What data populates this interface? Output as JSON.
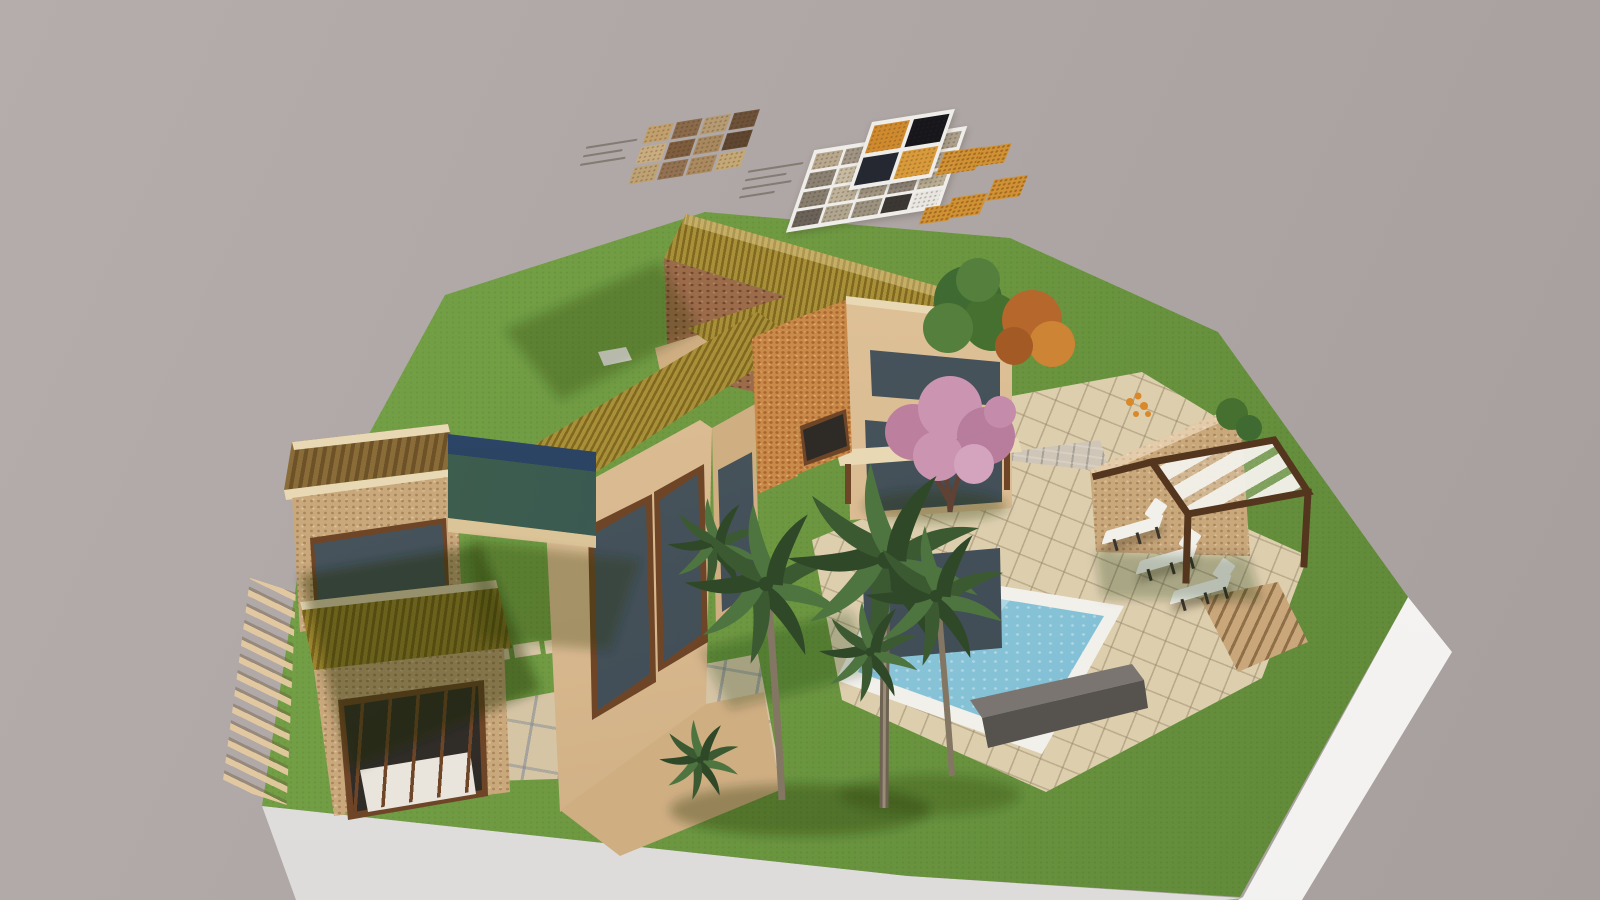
{
  "scene": {
    "type": "3d-architectural-render",
    "description": "Aerial 3D rendering of a Mediterranean stone villa on a floating grass plot with pool, pergola, palm trees, pink blossom tree, stone barn, two stacked stone tower pavilions linked by a glass bridge, paved paths, exterior stairs, and floating material sample boards above the model",
    "objects": [
      "stone-barn",
      "main-villa",
      "tower-pavilion-upper",
      "tower-pavilion-lower",
      "glass-bridge",
      "swimming-pool",
      "pool-bench",
      "pool-terrace",
      "upper-terrace",
      "brick-stair-ramp",
      "wood-steps",
      "floating-stair",
      "paved-path",
      "stepping-stones",
      "pergola",
      "pergola-stone-wall",
      "lounge-chairs",
      "palm-trees",
      "pink-blossom-tree",
      "green-tree",
      "autumn-tree",
      "bushes",
      "material-sample-boards",
      "white-display-plinth"
    ]
  },
  "colors": {
    "background_top": "#b5adab",
    "background_bottom": "#a79f9d",
    "grass": "#6f9a42",
    "grass_dark": "#5c8536",
    "plinth_front": "#e6e5e3",
    "plinth_right": "#f1f0ee",
    "paver": "#ddcfae",
    "path": "#d5c5a5",
    "stone_light": "#c9a87c",
    "stone_dark": "#9c6b4a",
    "roof_gold": "#a8903a",
    "roof_gold_dark": "#80691f",
    "roof_slat": "#8a6c38",
    "roof_slat_dark": "#6d5228",
    "stucco": "#e3c69e",
    "stucco_shade": "#cfae82",
    "fascia": "#e9d8b4",
    "frame_wood": "#6e4526",
    "glass": "#3a4650",
    "glass_dark": "#2e2a26",
    "bridge_roof": "#24384f",
    "water_light": "#d6edf2",
    "water": "#8cc6da",
    "water_deep": "#74b6cc",
    "coping": "#f2f0ea",
    "bench_top": "#7a7570",
    "bench_front": "#56524e",
    "pergola_wood": "#54361e",
    "canopy": "#f2f0ea",
    "pink_1": "#cb95b2",
    "pink_2": "#b87c9d",
    "palm_1": "#3c5a32",
    "palm_2": "#4e7440",
    "palm_3": "#2f4928",
    "palm_trunk": "#837663",
    "tree_green": "#3f6b33",
    "tree_green_2": "#547f3c",
    "autumn": "#b5672c",
    "autumn_2": "#cd8434",
    "bush": "#46702f",
    "trunk": "#6b513c",
    "swatch_orange": "#d2922f",
    "swatch_black": "#16161c",
    "swatch_navy": "#232833",
    "board_white": "#efede9",
    "label_dash": "#6b6258",
    "flower_orange": "#d9882a"
  },
  "material_boards": [
    {
      "id": "board-a",
      "rows": 3,
      "cols": 4,
      "tiles": [
        "#c2a06e",
        "#8a6a4a",
        "#b59a72",
        "#6d5138",
        "#c9ad80",
        "#7e5c3e",
        "#a8885e",
        "#5f4630",
        "#bfa274",
        "#937252",
        "#ab8a60",
        "#c4a876"
      ]
    },
    {
      "id": "board-b",
      "rows": 4,
      "cols": 5,
      "tiles": [
        "#b8a88e",
        "#a09484",
        "#c0b49c",
        "#948a7a",
        "#aca08c",
        "#8c8274",
        "#c6baa2",
        "#a89c88",
        "#9a9082",
        "#b4a892",
        "#887e70",
        "#beb29a",
        "#a49a86",
        "#90867a",
        "#baae96",
        "#6b635a",
        "#b0a690",
        "#9c9280",
        "#3a3734",
        "#e8e6e0"
      ]
    },
    {
      "id": "board-c",
      "rows": 2,
      "cols": 2,
      "tiles": [
        "#d08a2e",
        "#16161c",
        "#232833",
        "#d89a3a"
      ]
    }
  ],
  "furniture": {
    "lounge_chairs": 3
  },
  "vegetation": {
    "palm_trees": 3,
    "low_palms": 2,
    "pink_blossom_tree": 1,
    "green_tree": 1,
    "autumn_tree": 1,
    "bushes": 2
  }
}
